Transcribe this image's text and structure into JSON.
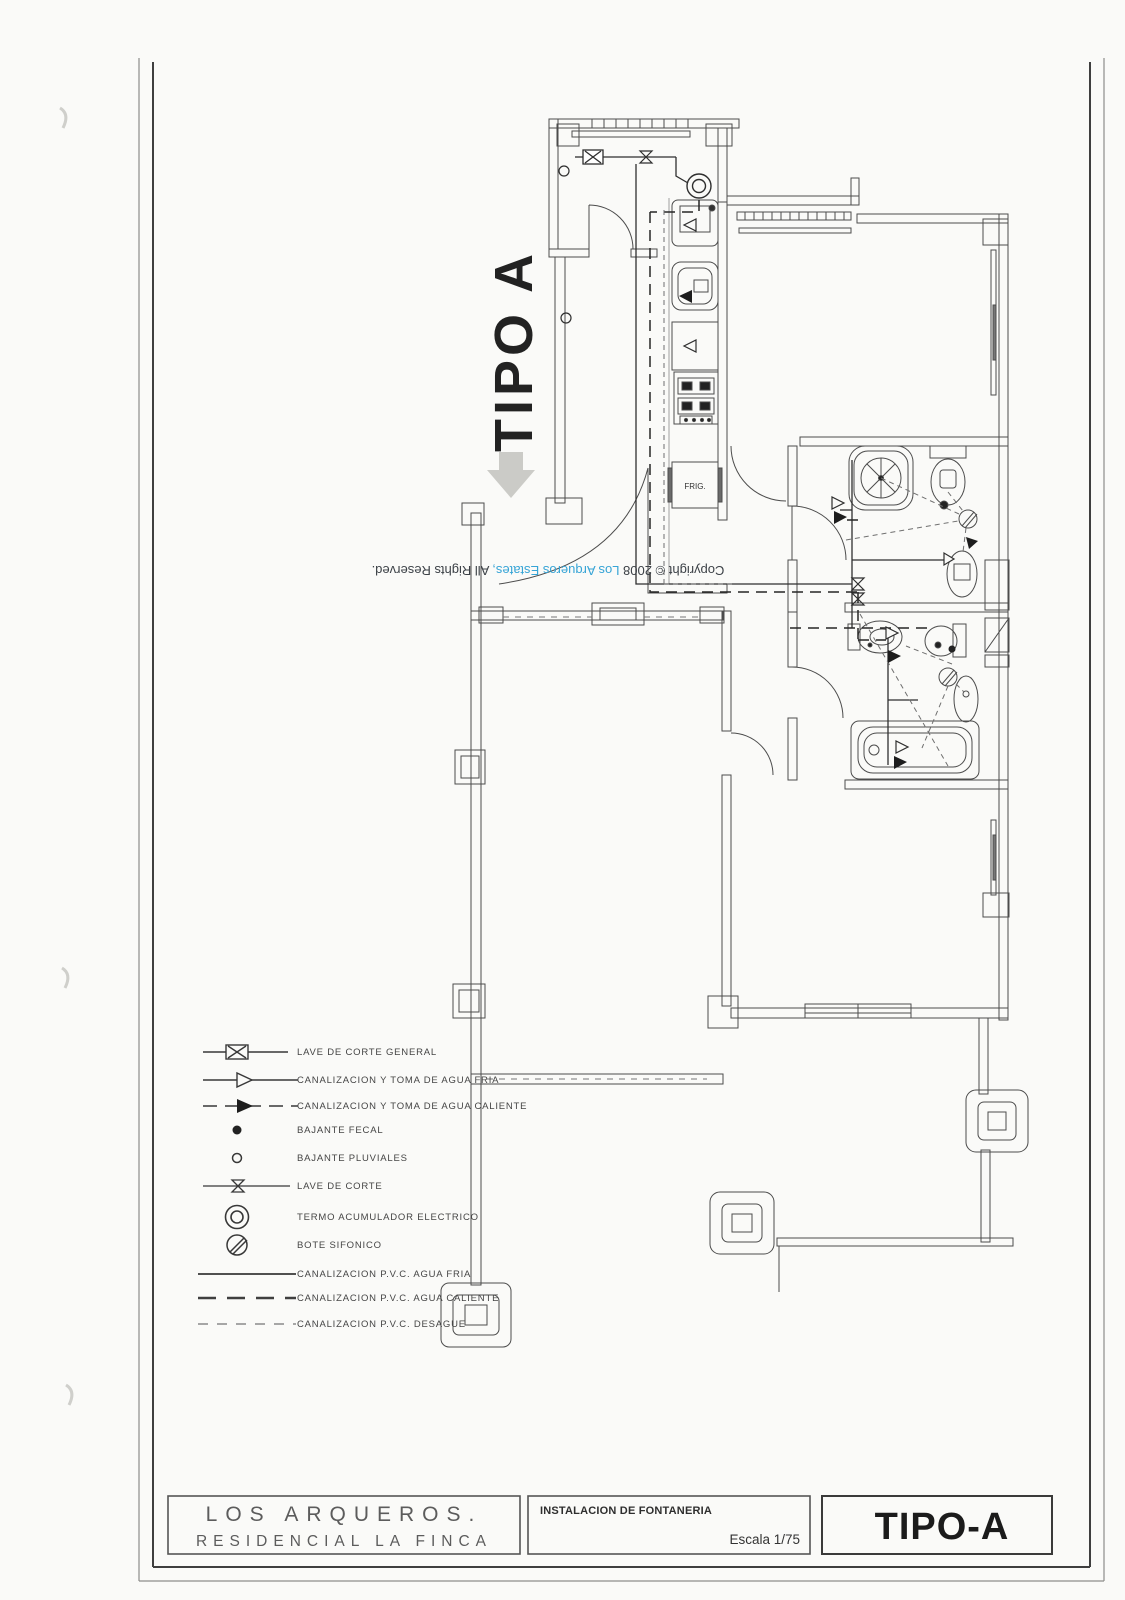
{
  "sheet": {
    "watermark_label": "TIPO A",
    "copyright": {
      "prefix": "Copyright © 2008 ",
      "brand": "Los Arqueros Estates,",
      "suffix": " All Rights Reserved."
    },
    "plan": {
      "fridge_label": "FRIG."
    },
    "legend": {
      "items": [
        {
          "symbol": "general-cut-valve",
          "label": "LAVE DE CORTE GENERAL"
        },
        {
          "symbol": "cold-water-supply-arrow",
          "label": "CANALIZACION Y TOMA DE AGUA FRIA"
        },
        {
          "symbol": "hot-water-supply-arrow",
          "label": "CANALIZACION Y TOMA DE AGUA CALIENTE"
        },
        {
          "symbol": "sewage-downpipe-dot",
          "label": "BAJANTE FECAL"
        },
        {
          "symbol": "rainwater-downpipe-circle",
          "label": "BAJANTE PLUVIALES"
        },
        {
          "symbol": "cut-valve",
          "label": "LAVE DE CORTE"
        },
        {
          "symbol": "electric-water-heater",
          "label": "TERMO ACUMULADOR ELECTRICO"
        },
        {
          "symbol": "siphon-pot",
          "label": "BOTE SIFONICO"
        },
        {
          "symbol": "pvc-cold-line",
          "label": "CANALIZACION P.V.C. AGUA FRIA"
        },
        {
          "symbol": "pvc-hot-line",
          "label": "CANALIZACION P.V.C. AGUA CALIENTE"
        },
        {
          "symbol": "pvc-drain-line",
          "label": "CANALIZACION P.V.C. DESAGUE"
        }
      ]
    },
    "title_block": {
      "project_name_line1": "LOS ARQUEROS.",
      "project_name_line2": "RESIDENCIAL LA FINCA",
      "drawing_title": "INSTALACION DE FONTANERIA",
      "scale_label": "Escala 1/75",
      "sheet_code": "TIPO-A"
    },
    "colors": {
      "paper": "#fafaf8",
      "ink": "#4c4c4c",
      "brand_blue": "#36a4d6"
    }
  }
}
